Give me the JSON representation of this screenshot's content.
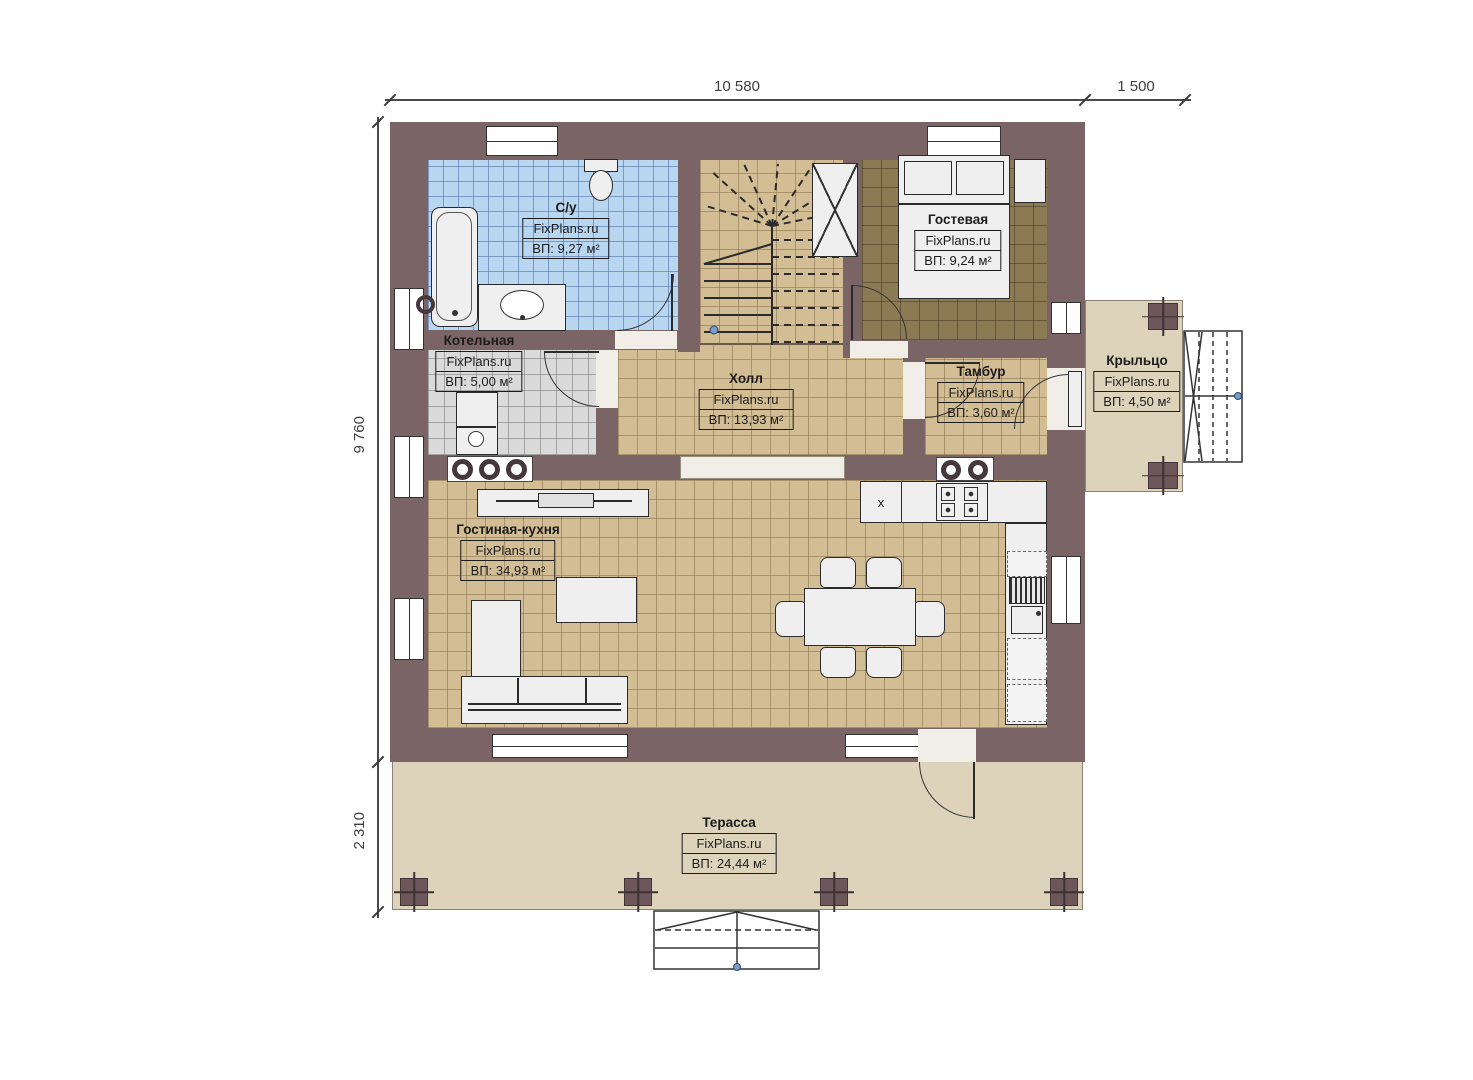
{
  "watermark": "FixPlans.ru",
  "dimensions": {
    "width_main": "10 580",
    "width_porch": "1 500",
    "height_main": "9 760",
    "height_terrace": "2 310"
  },
  "rooms": {
    "bathroom": {
      "name": "С/у",
      "area": "ВП: 9,27 м²"
    },
    "guest": {
      "name": "Гостевая",
      "area": "ВП: 9,24 м²"
    },
    "boiler": {
      "name": "Котельная",
      "area": "ВП: 5,00 м²"
    },
    "hall": {
      "name": "Холл",
      "area": "ВП: 13,93 м²"
    },
    "tambour": {
      "name": "Тамбур",
      "area": "ВП: 3,60 м²"
    },
    "porch": {
      "name": "Крыльцо",
      "area": "ВП: 4,50 м²"
    },
    "living": {
      "name": "Гостиная-кухня",
      "area": "ВП: 34,93 м²"
    },
    "terrace": {
      "name": "Терасса",
      "area": "ВП: 24,44 м²"
    }
  },
  "markers": {
    "x": "x"
  },
  "colors": {
    "wall": "#7a6465",
    "bathroom_floor": "#b9d6f1",
    "tile_floor": "#d2bd95",
    "guest_floor": "#8c7a54",
    "boiler_floor": "#dadada",
    "terrace_deck": "#ddd2ba",
    "entry_dot": "#7b9cc9"
  }
}
